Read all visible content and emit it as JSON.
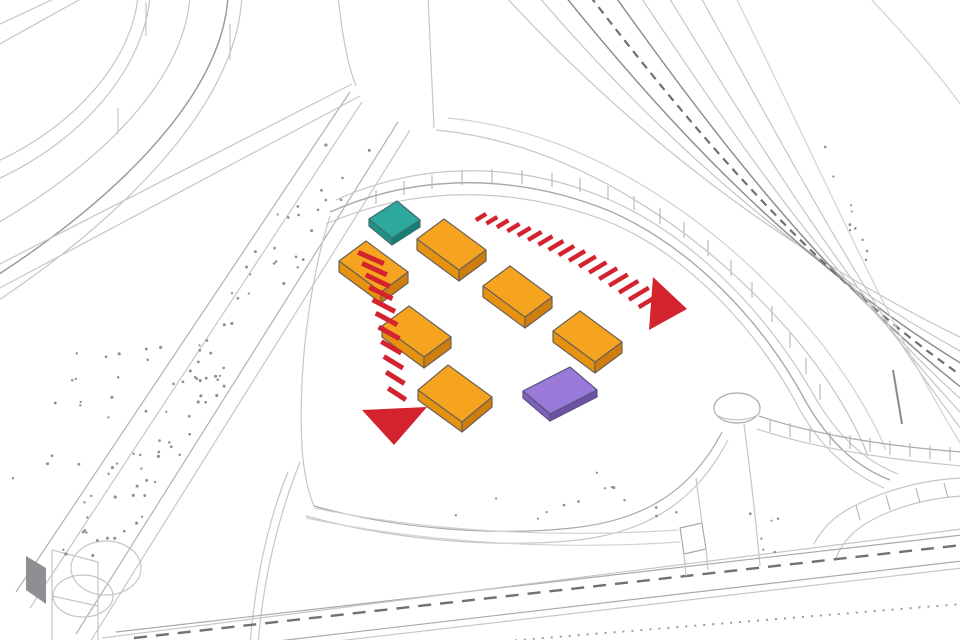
{
  "diagram": {
    "background": "#ffffff",
    "palette": {
      "line_light": "#c6c6ca",
      "line_mid": "#a9a9ae",
      "line_dark": "#85858a",
      "stipple": "#8f8f95",
      "arrow_red": "#d2232e"
    },
    "blocks": [
      {
        "id": "teal-building-block",
        "top": "#2ca89c",
        "side_left": "#1f938a",
        "side_right": "#147d74",
        "outline": "#3f6f6a",
        "origin": [
          397,
          201
        ],
        "edge_a": [
          23,
          19
        ],
        "edge_b": [
          -28,
          18
        ],
        "thickness": 7
      },
      {
        "id": "orange-building-block-1",
        "top": "#f6a41f",
        "side_left": "#e6920f",
        "side_right": "#cf7d0d",
        "outline": "#6a6158",
        "origin": [
          444,
          219
        ],
        "edge_a": [
          42,
          31
        ],
        "edge_b": [
          -27,
          20
        ],
        "thickness": 11
      },
      {
        "id": "orange-building-block-2",
        "top": "#f6a41f",
        "side_left": "#e6920f",
        "side_right": "#cf7d0d",
        "outline": "#6a6158",
        "origin": [
          366,
          241
        ],
        "edge_a": [
          42,
          31
        ],
        "edge_b": [
          -27,
          20
        ],
        "thickness": 11
      },
      {
        "id": "orange-building-block-3",
        "top": "#f6a41f",
        "side_left": "#e6920f",
        "side_right": "#cf7d0d",
        "outline": "#6a6158",
        "origin": [
          510,
          266
        ],
        "edge_a": [
          42,
          31
        ],
        "edge_b": [
          -27,
          20
        ],
        "thickness": 11
      },
      {
        "id": "orange-building-block-4",
        "top": "#f6a41f",
        "side_left": "#e6920f",
        "side_right": "#cf7d0d",
        "outline": "#6a6158",
        "origin": [
          409,
          306
        ],
        "edge_a": [
          42,
          31
        ],
        "edge_b": [
          -27,
          20
        ],
        "thickness": 11
      },
      {
        "id": "orange-building-block-5",
        "top": "#f6a41f",
        "side_left": "#e6920f",
        "side_right": "#cf7d0d",
        "outline": "#6a6158",
        "origin": [
          580,
          311
        ],
        "edge_a": [
          42,
          31
        ],
        "edge_b": [
          -27,
          20
        ],
        "thickness": 11
      },
      {
        "id": "orange-building-block-6",
        "top": "#f6a41f",
        "side_left": "#e6920f",
        "side_right": "#cf7d0d",
        "outline": "#6a6158",
        "origin": [
          448,
          365
        ],
        "edge_a": [
          44,
          32
        ],
        "edge_b": [
          -30,
          25
        ],
        "thickness": 10
      },
      {
        "id": "purple-building-block",
        "top": "#9a7ad8",
        "side_left": "#7e62bd",
        "side_right": "#6b53a4",
        "outline": "#5c5180",
        "origin": [
          570,
          367
        ],
        "edge_a": [
          27,
          23
        ],
        "edge_b": [
          -47,
          24
        ],
        "thickness": 7
      }
    ],
    "arrows": [
      {
        "id": "flow-arrow-east",
        "color": "#d2232e",
        "from": [
          481,
          217
        ],
        "ctrl": [
          568,
          242
        ],
        "to": [
          649,
          301
        ],
        "bar_count": 17,
        "bar_len_start": 12,
        "bar_len_end": 24,
        "bar_width": 4.4,
        "bar_angle_start": -31,
        "bar_angle_end": -31,
        "head": [
          [
            653,
            277
          ],
          [
            649,
            330
          ],
          [
            687,
            309
          ]
        ]
      },
      {
        "id": "flow-arrow-south",
        "color": "#d2232e",
        "from": [
          371,
          258
        ],
        "ctrl": [
          389,
          312
        ],
        "to": [
          397,
          394
        ],
        "bar_count": 11,
        "bar_len_start": 28,
        "bar_len_end": 21,
        "bar_width": 5,
        "bar_angle_start": 24,
        "bar_angle_end": 33,
        "head": [
          [
            362,
            410
          ],
          [
            427,
            407
          ],
          [
            394,
            445
          ]
        ]
      }
    ]
  }
}
